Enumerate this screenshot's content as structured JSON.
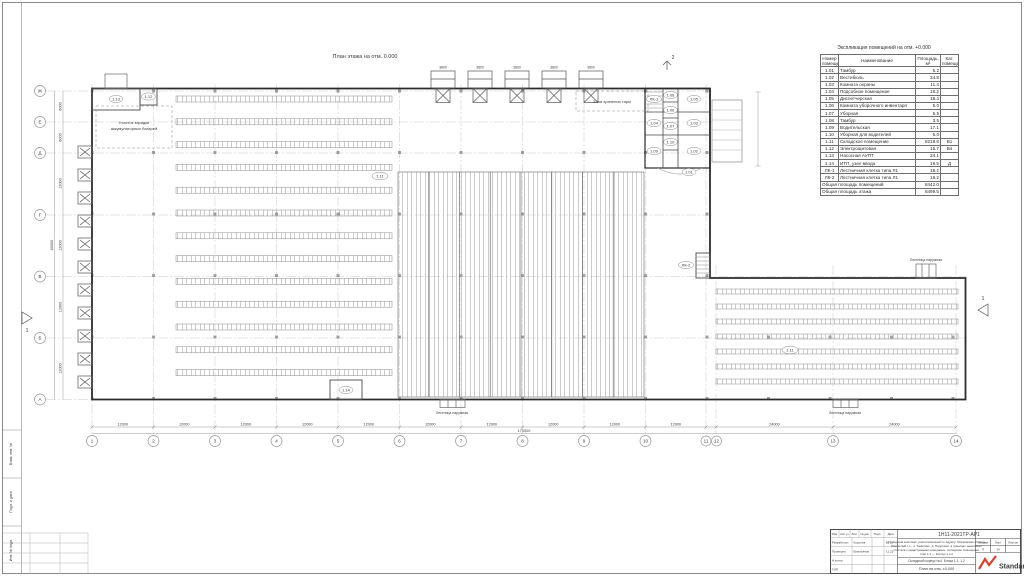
{
  "plan": {
    "title": "План этажа на отм. 0.000",
    "battery_zone_line1": "Участок зарядки",
    "battery_zone_line2": "аккумуляторных батарей",
    "tara_zone": "Зона хранения тары",
    "outside_stair": "Лестница наружная",
    "dock_dim": "3800",
    "section1": "1",
    "section2": "2",
    "tags": {
      "r101": "1.01",
      "r102": "1.02",
      "r103": "1.03",
      "r104": "1.04",
      "r105": "1.05",
      "r106": "1.06",
      "r107": "1.07",
      "r108": "1.08",
      "r109": "1.09",
      "r110": "1.10",
      "r111": "1.11",
      "r112": "1.12",
      "r113": "1.13",
      "r114": "1.14",
      "lk1": "ЛК-1",
      "lk2": "ЛК-2"
    }
  },
  "axes": {
    "bottom": [
      "1",
      "2",
      "3",
      "4",
      "5",
      "6",
      "7",
      "8",
      "9",
      "10",
      "11",
      "12",
      "13",
      "14"
    ],
    "left": [
      "Ж",
      "Е",
      "Д",
      "Г",
      "В",
      "Б",
      "А"
    ],
    "dim_12000": "12000",
    "dim_24000": "24000",
    "dim_6000": "6000",
    "total_bottom": "170000",
    "total_left": "60000"
  },
  "explication": {
    "title": "Экспликация помещений на отм. +0.000",
    "headers": [
      "Номер помещения",
      "Наименование",
      "Площадь, м²",
      "Кат. помещения"
    ],
    "rows": [
      {
        "n": "1.01",
        "name": "Тамбур",
        "area": "5.2",
        "cat": ""
      },
      {
        "n": "1.02",
        "name": "Вестибюль",
        "area": "34.8",
        "cat": ""
      },
      {
        "n": "1.03",
        "name": "Комната охраны",
        "area": "11.4",
        "cat": ""
      },
      {
        "n": "1.04",
        "name": "Подсобное помещение",
        "area": "18.2",
        "cat": ""
      },
      {
        "n": "1.05",
        "name": "Диспетчерская",
        "area": "18.4",
        "cat": ""
      },
      {
        "n": "1.06",
        "name": "Комната уборочного инвентаря",
        "area": "5.0",
        "cat": ""
      },
      {
        "n": "1.07",
        "name": "Уборная",
        "area": "5.5",
        "cat": ""
      },
      {
        "n": "1.08",
        "name": "Тамбур",
        "area": "3.5",
        "cat": ""
      },
      {
        "n": "1.09",
        "name": "Водительская",
        "area": "17.1",
        "cat": ""
      },
      {
        "n": "1.10",
        "name": "Уборная для водителей",
        "area": "5.0",
        "cat": ""
      },
      {
        "n": "1.11",
        "name": "Складское помещение",
        "area": "8219.8",
        "cat": "В1"
      },
      {
        "n": "1.12",
        "name": "Электрощитовая",
        "area": "15.7",
        "cat": "В4"
      },
      {
        "n": "1.13",
        "name": "Насосная АУПТ",
        "area": "34.1",
        "cat": ""
      },
      {
        "n": "1.14",
        "name": "ИТП, узел ввода",
        "area": "19.5",
        "cat": "Д"
      },
      {
        "n": "ЛК-1",
        "name": "Лестничная клетка типа Л1",
        "area": "18.2",
        "cat": ""
      },
      {
        "n": "ЛК-2",
        "name": "Лестничная клетка типа Л1",
        "area": "18.2",
        "cat": ""
      }
    ],
    "total_rooms_label": "Общая площадь помещений",
    "total_rooms": "8442.0",
    "total_floor_label": "Общая площадь этажа",
    "total_floor": "8499.5"
  },
  "titleblock": {
    "doc_number": "1Н11-2021ТР-АР1",
    "project_lines": [
      "«Складской комплекс, расположенный по адресу: Московская область,",
      "Раменский г.о., п. Томилино, д. Подолино, в границах земельных",
      "участков с кадастровыми номерами». Складские помещения,",
      "этап 1.1 — Корпус 1 и 2"
    ],
    "object_name": "Складской корпус №4. Блоки 1.1, 1.2",
    "sheet_name": "План на отм. ±0.000",
    "header_cols": [
      "Изм.",
      "Кол.уч",
      "Лист",
      "№ док.",
      "Подп.",
      "Дата"
    ],
    "roles": [
      {
        "role": "Разработал",
        "name": "Королев",
        "date": "11.21"
      },
      {
        "role": "Проверил",
        "name": "Емельянов",
        "date": "11.21"
      },
      {
        "role": "Н.контр.",
        "name": "",
        "date": ""
      },
      {
        "role": "ГИП",
        "name": "",
        "date": ""
      }
    ],
    "stage_headers": [
      "Стадия",
      "Лист",
      "Листов"
    ],
    "stage": "П",
    "sheet_num": "14",
    "sheets_total": "",
    "logo": "Standart",
    "accent": "#d6402e"
  },
  "margin": {
    "labels": [
      "Взам. инв. №",
      "Подп. и дата",
      "Инв. № подл."
    ]
  }
}
